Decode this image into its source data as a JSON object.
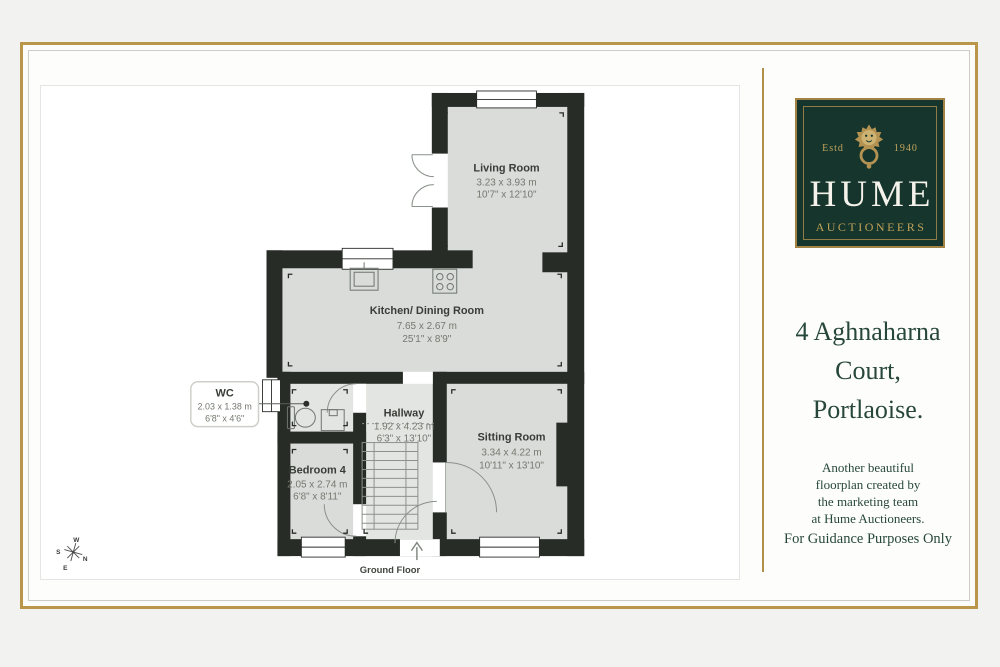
{
  "page": {
    "floor_label": "Ground Floor",
    "brand": {
      "estd_left": "Estd",
      "estd_right": "1940",
      "name": "HUME",
      "subtitle": "AUCTIONEERS"
    },
    "address": {
      "line1": "4 Aghnaharna",
      "line2": "Court,",
      "line3": "Portlaoise."
    },
    "tagline": {
      "lines": [
        "Another beautiful",
        "floorplan created by",
        "the marketing team",
        "at Hume Auctioneers."
      ],
      "guidance": "For Guidance Purposes Only"
    },
    "compass": {
      "n": "N",
      "s": "S",
      "e": "E",
      "w": "W"
    }
  },
  "rooms": {
    "living": {
      "name": "Living Room",
      "metric": "3.23 x 3.93 m",
      "imperial": "10'7\" x 12'10\""
    },
    "kitchen": {
      "name": "Kitchen/ Dining Room",
      "metric": "7.65 x 2.67 m",
      "imperial": "25'1\" x 8'9\""
    },
    "wc": {
      "name": "WC",
      "metric": "2.03 x 1.38 m",
      "imperial": "6'8\" x 4'6\""
    },
    "hallway": {
      "name": "Hallway",
      "metric": "1.92 x 4.23 m",
      "imperial": "6'3\" x 13'10\""
    },
    "bedroom4": {
      "name": "Bedroom 4",
      "metric": "2.05 x 2.74 m",
      "imperial": "6'8\" x 8'11\""
    },
    "sitting": {
      "name": "Sitting Room",
      "metric": "3.34 x 4.22 m",
      "imperial": "10'11\" x 13'10\""
    }
  },
  "colors": {
    "frame_gold": "#b9964a",
    "brand_green": "#16352c",
    "brand_gold": "#bfa156",
    "text_green": "#27473c",
    "wall": "#282c27",
    "room_floor": "#d9dcd9",
    "hall_floor": "#e3e5e2"
  }
}
